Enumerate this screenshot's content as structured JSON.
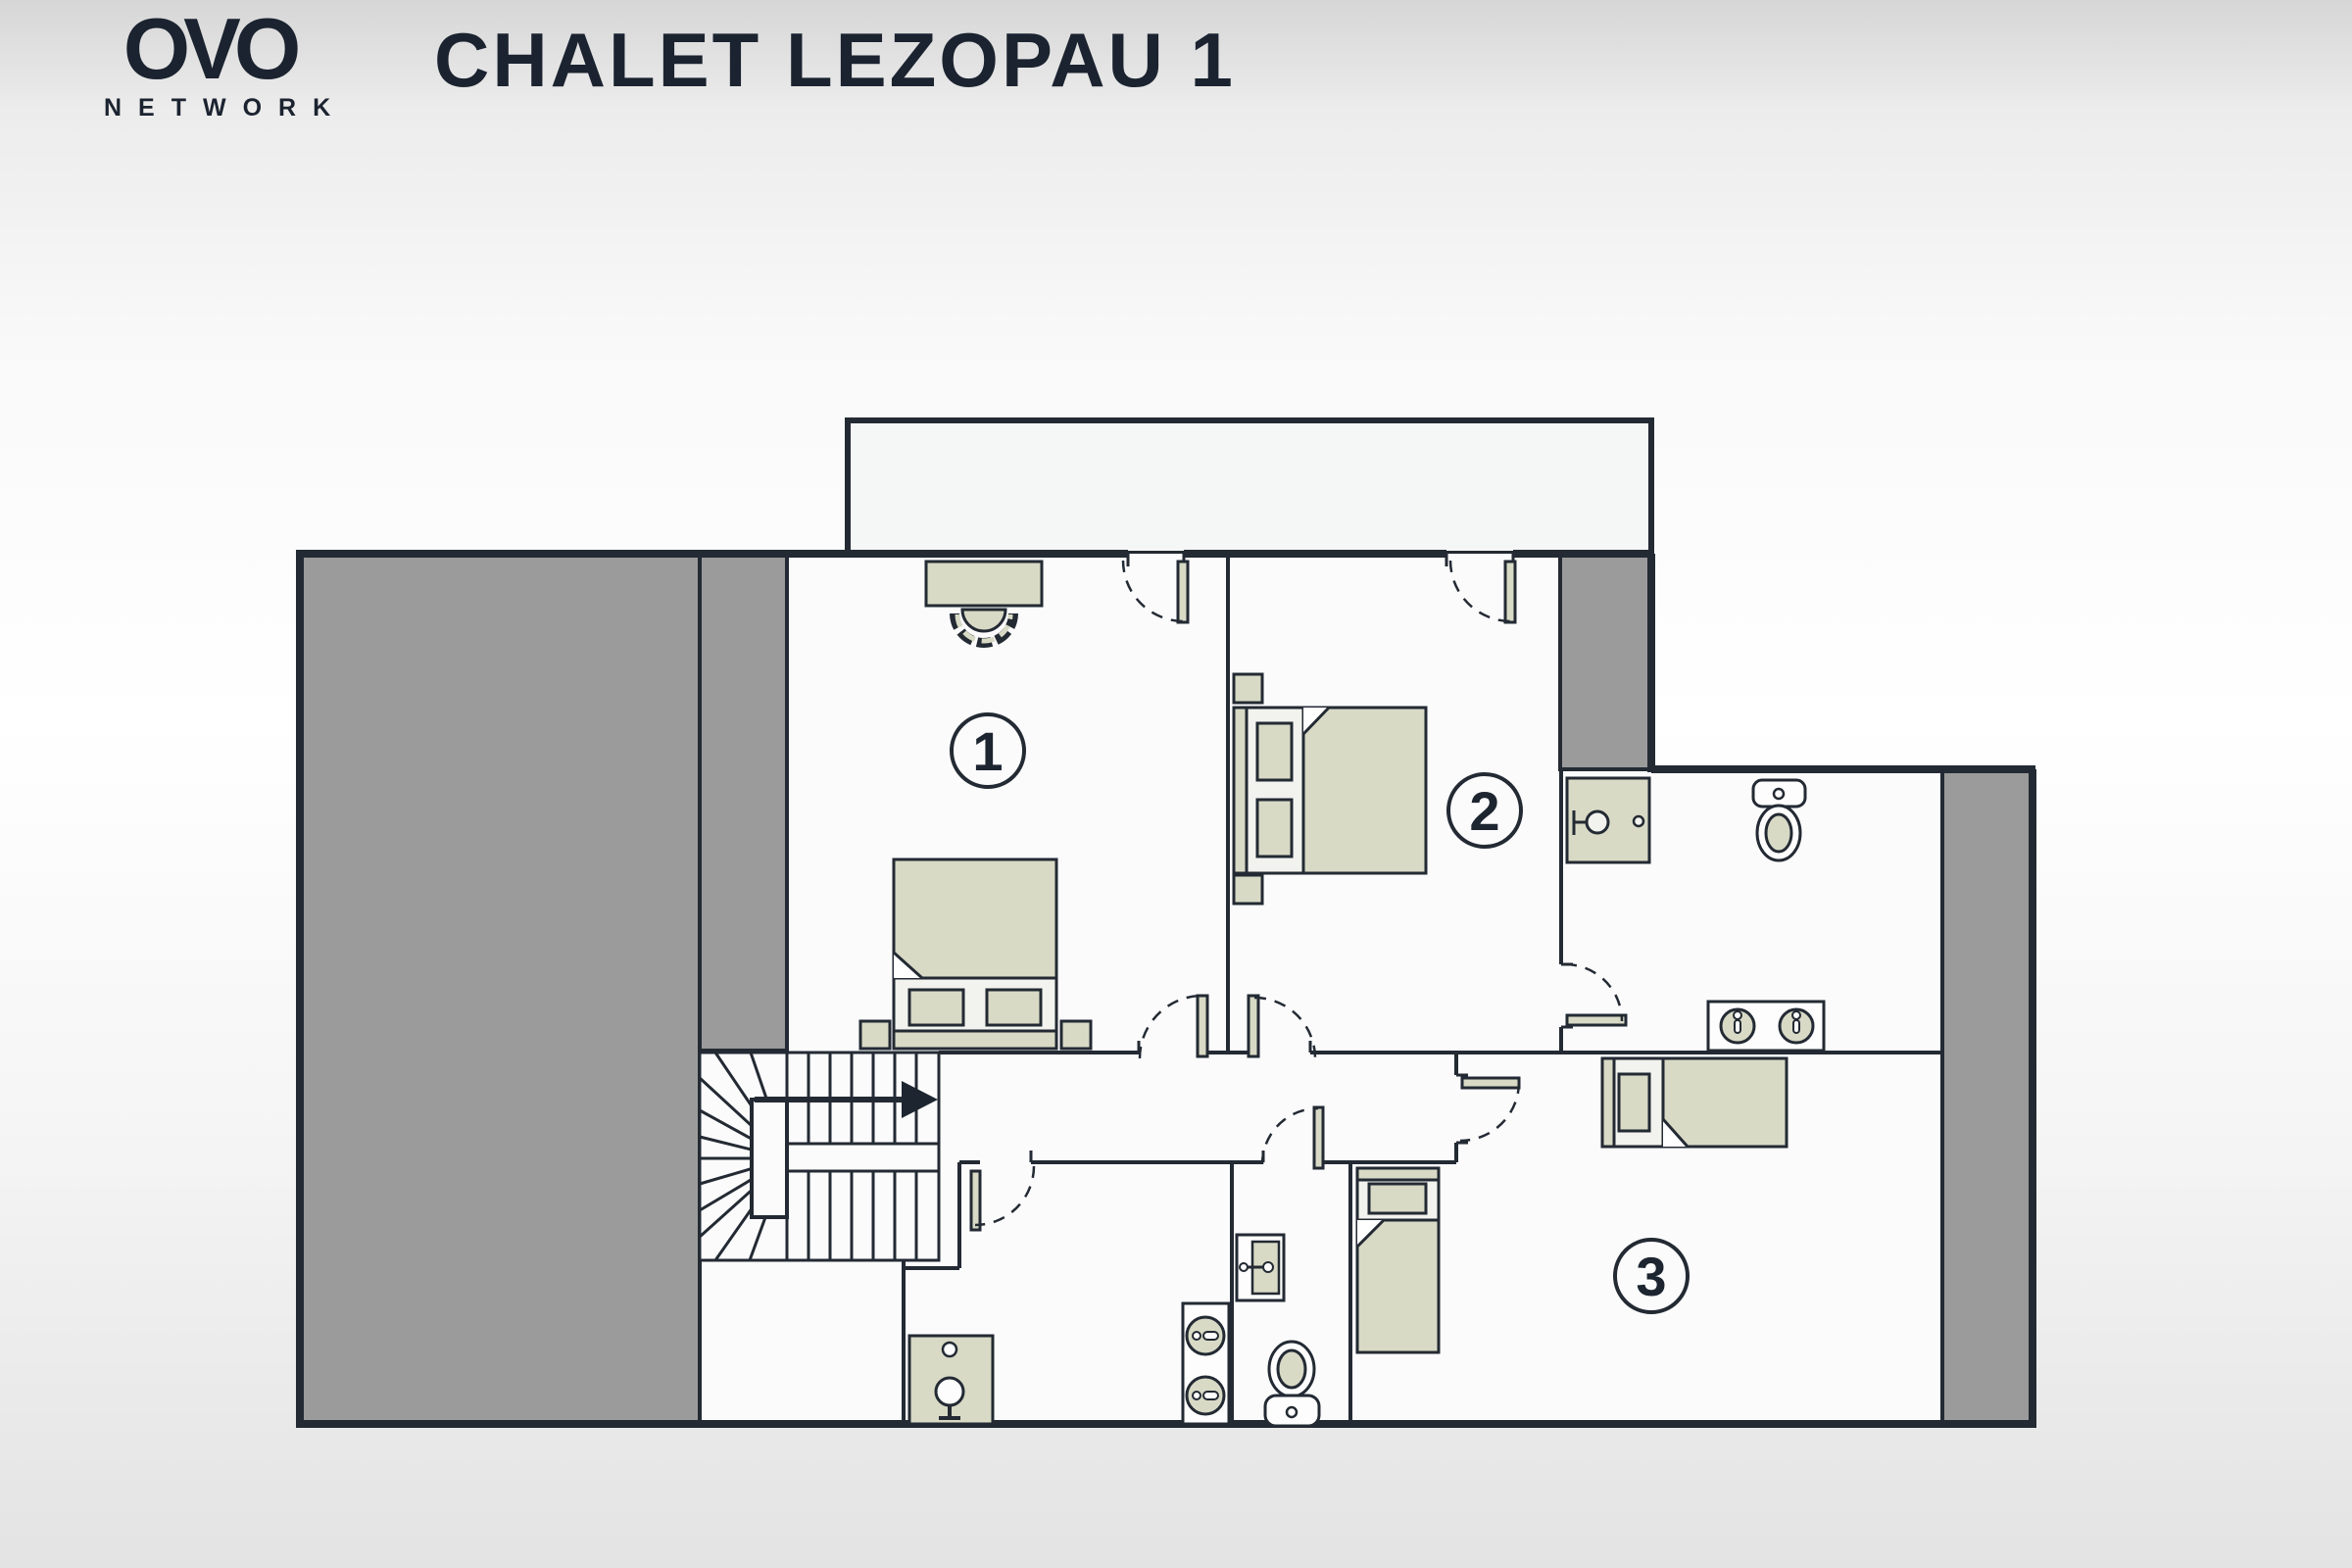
{
  "header": {
    "logo_primary": "OVO",
    "logo_secondary": "NETWORK",
    "title": "CHALET LEZOPAU 1"
  },
  "floorplan": {
    "rooms": [
      {
        "number": "1",
        "furniture": [
          "desk",
          "chair",
          "double-bed",
          "nightstand",
          "nightstand"
        ]
      },
      {
        "number": "2",
        "furniture": [
          "double-bed",
          "nightstand",
          "nightstand"
        ]
      },
      {
        "number": "3",
        "furniture": [
          "single-bed-horizontal",
          "single-bed-vertical"
        ]
      }
    ],
    "bathrooms": [
      {
        "location": "top-right",
        "fixtures": [
          "shower",
          "toilet",
          "double-sink-vanity"
        ]
      },
      {
        "location": "bottom-middle-left",
        "fixtures": [
          "washbasin-unit"
        ]
      },
      {
        "location": "bottom-middle",
        "fixtures": [
          "double-round-sink-vanity"
        ]
      },
      {
        "location": "bottom-middle-right",
        "fixtures": [
          "wall-basin",
          "toilet"
        ]
      }
    ],
    "features": [
      "balcony",
      "terrace",
      "staircase",
      "direction-arrow",
      "door-swings"
    ],
    "colors": {
      "wall": "#232a33",
      "furniture": "#d8dac6",
      "frame_fill": "#f2f3ee",
      "terrace": "#9b9b9b",
      "floor": "#fbfbfc",
      "balcony": "#f5f6f6",
      "accent_text": "#1b2330"
    }
  }
}
